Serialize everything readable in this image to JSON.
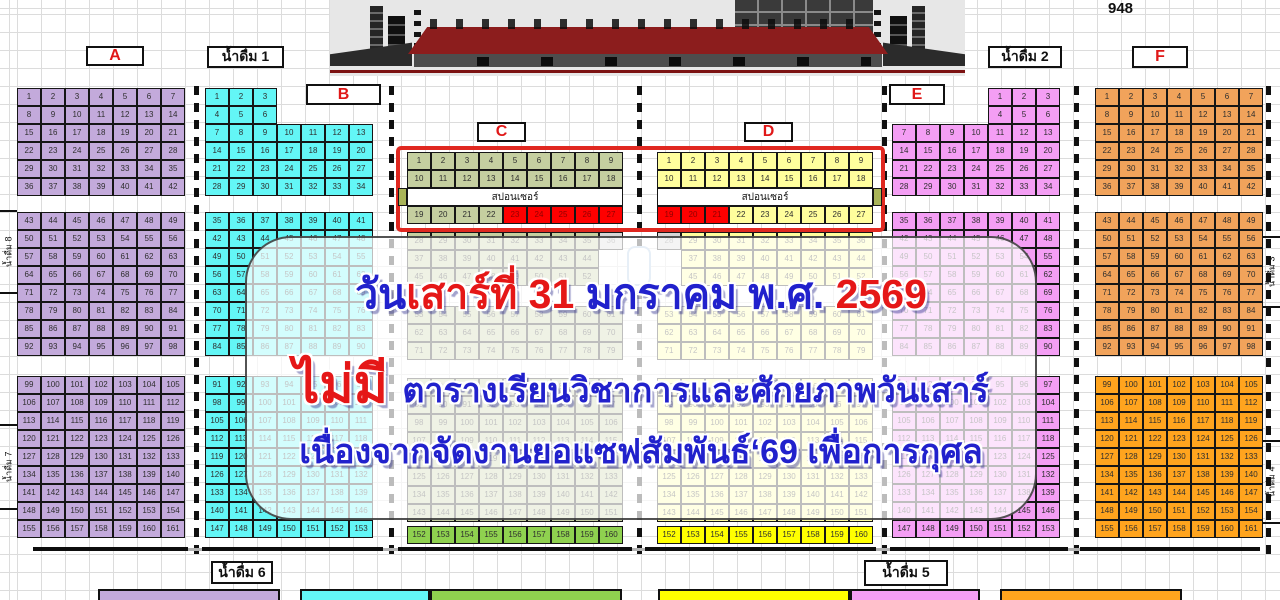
{
  "total_seats": "948",
  "sponsor_label": "สปอนเซอร์",
  "announcement": {
    "line1": [
      {
        "text": "วัน",
        "color": "blue"
      },
      {
        "text": "เสาร์ที่ 31",
        "color": "red"
      },
      {
        "text": " มกราคม พ.ศ. ",
        "color": "blue"
      },
      {
        "text": "2569",
        "color": "red"
      }
    ],
    "line2": [
      {
        "text": "ไม่มี ",
        "color": "red",
        "big": true
      },
      {
        "text": "ตารางเรียนวิชาการและศักยภาพวันเสาร์",
        "color": "blue"
      }
    ],
    "line3": [
      {
        "text": "เนื่องจากจัดงานยอแซฟสัมพันธ์‘69 เพื่อการกุศล",
        "color": "blue"
      }
    ]
  },
  "labels": [
    {
      "text": "A",
      "cls": "red",
      "x": 86,
      "y": 46,
      "w": 58,
      "h": 20
    },
    {
      "text": "น้ำดื่ม 1",
      "cls": "black",
      "x": 207,
      "y": 46,
      "w": 77,
      "h": 22
    },
    {
      "text": "B",
      "cls": "red",
      "x": 306,
      "y": 84,
      "w": 75,
      "h": 21
    },
    {
      "text": "C",
      "cls": "red",
      "x": 477,
      "y": 122,
      "w": 49,
      "h": 20
    },
    {
      "text": "D",
      "cls": "red",
      "x": 744,
      "y": 122,
      "w": 49,
      "h": 20
    },
    {
      "text": "E",
      "cls": "red",
      "x": 889,
      "y": 84,
      "w": 56,
      "h": 21
    },
    {
      "text": "น้ำดื่ม 2",
      "cls": "black",
      "x": 988,
      "y": 46,
      "w": 74,
      "h": 22
    },
    {
      "text": "F",
      "cls": "red",
      "x": 1132,
      "y": 46,
      "w": 56,
      "h": 22
    },
    {
      "text": "น้ำดื่ม 6",
      "cls": "black",
      "x": 211,
      "y": 561,
      "w": 62,
      "h": 23
    },
    {
      "text": "น้ำดื่ม 5",
      "cls": "black",
      "x": 864,
      "y": 560,
      "w": 84,
      "h": 26
    }
  ],
  "water_labels_rotated": [
    {
      "text": "น้ำดื่ม 8",
      "x": 0,
      "y": 210,
      "h": 84
    },
    {
      "text": "น้ำดื่ม 7",
      "x": 0,
      "y": 424,
      "h": 86
    },
    {
      "text": "น้ำดื่ม 3",
      "x": 1263,
      "y": 236,
      "h": 72
    },
    {
      "text": "น้ำดื่ม 4",
      "x": 1263,
      "y": 440,
      "h": 84
    }
  ],
  "legend": [
    {
      "section": "A",
      "color": "#C3AADB",
      "x": 98,
      "w": 182
    },
    {
      "section": "B",
      "color": "#63F6F6",
      "x": 300,
      "w": 130
    },
    {
      "section": "C",
      "color": "#8FD14F",
      "x": 430,
      "w": 192
    },
    {
      "section": "D",
      "color": "#FFFF00",
      "x": 658,
      "w": 192
    },
    {
      "section": "E",
      "color": "#F49EF4",
      "x": 850,
      "w": 130
    },
    {
      "section": "F",
      "color": "#FFA41E",
      "x": 1000,
      "w": 182
    }
  ],
  "colors": {
    "A": "#C3AADB",
    "B": "#63F6F6",
    "C": "#C5CFA0",
    "C_bright": "#8FD14F",
    "D": "#FFFE9D",
    "D_bright": "#FFFF00",
    "E": "#F49EF4",
    "F": "#F1A35B",
    "F_bright": "#FFA41E",
    "red_seat": "#FE0000",
    "gray_seat": "#D6D6D6",
    "accent_red": "#E02820",
    "sponsor_flank": "#A9B458"
  },
  "sections": [
    {
      "name": "A",
      "x": 17,
      "cols": 7,
      "fill": "A",
      "bright": "A",
      "blocks": [
        {
          "y": 88,
          "rows": [
            {
              "s": 1
            },
            {
              "s": 8
            },
            {
              "s": 15
            },
            {
              "s": 22
            },
            {
              "s": 29
            },
            {
              "s": 36
            }
          ]
        },
        {
          "y": 212,
          "rows": [
            {
              "s": 43
            },
            {
              "s": 50
            },
            {
              "s": 57
            },
            {
              "s": 64
            },
            {
              "s": 71
            },
            {
              "s": 78
            },
            {
              "s": 85
            },
            {
              "s": 92
            }
          ]
        },
        {
          "y": 376,
          "rows": [
            {
              "s": 99
            },
            {
              "s": 106
            },
            {
              "s": 113
            },
            {
              "s": 120
            },
            {
              "s": 127
            },
            {
              "s": 134
            },
            {
              "s": 141
            },
            {
              "s": 148
            },
            {
              "s": 155
            }
          ]
        }
      ]
    },
    {
      "name": "B",
      "x": 205,
      "cols": 7,
      "fill": "B",
      "bright": "B",
      "blocks": [
        {
          "y": 88,
          "rows": [
            {
              "s": 1,
              "c": 3
            },
            {
              "s": 4,
              "c": 3
            },
            {
              "s": 7
            },
            {
              "s": 14
            },
            {
              "s": 21
            },
            {
              "s": 28
            }
          ]
        },
        {
          "y": 212,
          "rows": [
            {
              "s": 35
            },
            {
              "s": 42
            },
            {
              "s": 49
            },
            {
              "s": 56
            },
            {
              "s": 63
            },
            {
              "s": 70
            },
            {
              "s": 77
            },
            {
              "s": 84
            }
          ]
        },
        {
          "y": 376,
          "rows": [
            {
              "s": 91
            },
            {
              "s": 98
            },
            {
              "s": 105
            },
            {
              "s": 112
            },
            {
              "s": 119
            },
            {
              "s": 126
            },
            {
              "s": 133
            },
            {
              "s": 140
            },
            {
              "s": 147
            }
          ]
        }
      ]
    },
    {
      "name": "C",
      "x": 407,
      "cols": 9,
      "fill": "C",
      "bright": "C_bright",
      "blocks": [
        {
          "y": 152,
          "rows": [
            {
              "s": 1
            },
            {
              "s": 10
            }
          ]
        },
        {
          "y": 188,
          "rows": [
            {
              "sponsor": true,
              "flank": "left"
            },
            {
              "s": 19,
              "red": [
                23,
                24,
                25,
                26,
                27
              ]
            }
          ]
        },
        {
          "y": 232,
          "rows": [
            {
              "s": 28,
              "gray": [
                36
              ]
            },
            {
              "s": 37,
              "c": 8
            },
            {
              "s": 45,
              "c": 8
            }
          ]
        },
        {
          "y": 306,
          "rows": [
            {
              "s": 53
            },
            {
              "s": 62
            },
            {
              "s": 71
            }
          ]
        },
        {
          "y": 378,
          "rows": [
            {
              "s": 80
            },
            {
              "s": 89
            },
            {
              "s": 98
            },
            {
              "s": 107
            },
            {
              "s": 116
            },
            {
              "s": 125
            },
            {
              "s": 134
            },
            {
              "s": 143
            }
          ]
        },
        {
          "y": 526,
          "rows": [
            {
              "s": 152,
              "hl": true
            }
          ]
        }
      ]
    },
    {
      "name": "D",
      "x": 657,
      "cols": 9,
      "fill": "D",
      "bright": "D_bright",
      "blocks": [
        {
          "y": 152,
          "rows": [
            {
              "s": 1
            },
            {
              "s": 10
            }
          ]
        },
        {
          "y": 188,
          "rows": [
            {
              "sponsor": true,
              "flank": "right"
            },
            {
              "s": 19,
              "red": [
                19,
                20,
                21
              ]
            }
          ]
        },
        {
          "y": 232,
          "rows": [
            {
              "s": 28,
              "gray": [
                28
              ]
            },
            {
              "s": 37,
              "c": 8,
              "o": 1
            },
            {
              "s": 45,
              "c": 8,
              "o": 1
            }
          ]
        },
        {
          "y": 306,
          "rows": [
            {
              "s": 53
            },
            {
              "s": 62
            },
            {
              "s": 71
            }
          ]
        },
        {
          "y": 378,
          "rows": [
            {
              "s": 80
            },
            {
              "s": 89
            },
            {
              "s": 98
            },
            {
              "s": 107
            },
            {
              "s": 116
            },
            {
              "s": 125
            },
            {
              "s": 134
            },
            {
              "s": 143
            }
          ]
        },
        {
          "y": 526,
          "rows": [
            {
              "s": 152,
              "hl": true
            }
          ]
        }
      ]
    },
    {
      "name": "E",
      "x": 892,
      "cols": 7,
      "fill": "E",
      "bright": "E",
      "blocks": [
        {
          "y": 88,
          "rows": [
            {
              "s": 1,
              "c": 3,
              "o": 4
            },
            {
              "s": 4,
              "c": 3,
              "o": 4
            },
            {
              "s": 7
            },
            {
              "s": 14
            },
            {
              "s": 21
            },
            {
              "s": 28
            }
          ]
        },
        {
          "y": 212,
          "rows": [
            {
              "s": 35
            },
            {
              "s": 42
            },
            {
              "s": 49
            },
            {
              "s": 56
            },
            {
              "s": 63
            },
            {
              "s": 70
            },
            {
              "s": 77
            },
            {
              "s": 84
            }
          ]
        },
        {
          "y": 376,
          "rows": [
            {
              "s": 91
            },
            {
              "s": 98
            },
            {
              "s": 105
            },
            {
              "s": 112
            },
            {
              "s": 119
            },
            {
              "s": 126
            },
            {
              "s": 133
            },
            {
              "s": 140
            },
            {
              "s": 147
            }
          ]
        }
      ]
    },
    {
      "name": "F",
      "x": 1095,
      "cols": 7,
      "fill": "F",
      "bright": "F",
      "blocks": [
        {
          "y": 88,
          "rows": [
            {
              "s": 1
            },
            {
              "s": 8
            },
            {
              "s": 15
            },
            {
              "s": 22
            },
            {
              "s": 29
            },
            {
              "s": 36
            }
          ]
        },
        {
          "y": 212,
          "rows": [
            {
              "s": 43
            },
            {
              "s": 50
            },
            {
              "s": 57
            },
            {
              "s": 64
            },
            {
              "s": 71
            },
            {
              "s": 78
            },
            {
              "s": 85
            },
            {
              "s": 92
            }
          ]
        },
        {
          "y": 376,
          "fillKey": "F_bright",
          "rows": [
            {
              "s": 99
            },
            {
              "s": 106
            },
            {
              "s": 113
            },
            {
              "s": 120
            },
            {
              "s": 127
            },
            {
              "s": 134
            },
            {
              "s": 141
            },
            {
              "s": 148
            },
            {
              "s": 155
            }
          ]
        }
      ]
    }
  ]
}
